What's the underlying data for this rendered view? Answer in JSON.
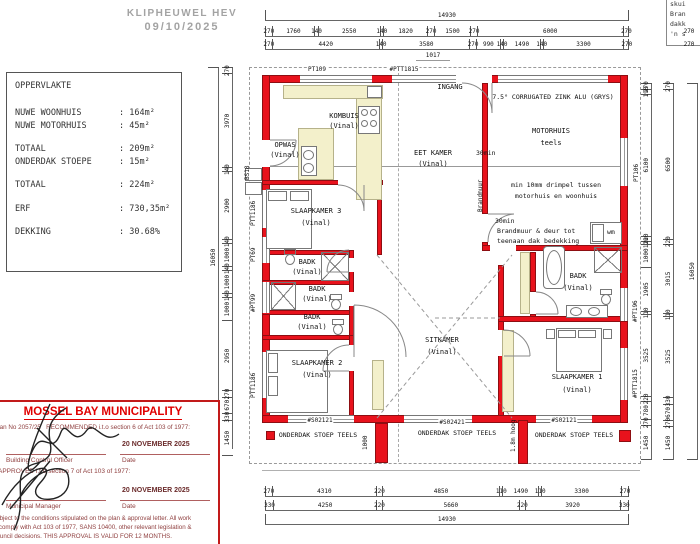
{
  "watermark": {
    "site": "KLIPHEUWEL HEV",
    "date": "09/10/2025"
  },
  "area_table": {
    "title": "OPPERVLAKTE",
    "rows": [
      {
        "label": "NUWE WOONHUIS",
        "value": ": 164m²"
      },
      {
        "label": "NUWE MOTORHUIS",
        "value": ":  45m²"
      },
      {
        "label": "TOTAAL",
        "value": ": 209m²"
      },
      {
        "label": "ONDERDAK STOEPE",
        "value": ": 15m²"
      },
      {
        "label": "TOTAAL",
        "value": ": 224m²"
      },
      {
        "label": "ERF",
        "value": ": 730,35m²"
      },
      {
        "label": "DEKKING",
        "value": ": 30.68%"
      }
    ]
  },
  "corner_note": {
    "lines": [
      "skui",
      "Bran",
      "dakk",
      "'n s"
    ]
  },
  "plan": {
    "rooms": {
      "kombuis": {
        "name": "KOMBUIS",
        "floor": "(Vinal)"
      },
      "opwas": {
        "name": "OPWAS",
        "floor": "(Vinal)"
      },
      "eetkamer": {
        "name": "EET KAMER",
        "floor": "(Vinal)"
      },
      "motorhuis": {
        "name": "MOTORHUIS",
        "floor": "teels"
      },
      "ingang": {
        "name": "INGANG"
      },
      "slaapkamer3": {
        "name": "SLAAPKAMER 3",
        "floor": "(Vinal)"
      },
      "badk_a": {
        "name": "BADK",
        "floor": "(Vinal)"
      },
      "badk_b": {
        "name": "BADK",
        "floor": "(Vinal)"
      },
      "badk_c": {
        "name": "BADK",
        "floor": "(Vinal)"
      },
      "badk_d": {
        "name": "BADK",
        "floor": "(Vinal)"
      },
      "slaapkamer2": {
        "name": "SLAAPKAMER 2",
        "floor": "(Vinal)"
      },
      "sitkamer": {
        "name": "SITKAMER",
        "floor": "(Vinal)"
      },
      "slaapkamer1": {
        "name": "SLAAPKAMER 1",
        "floor": "(Vinal)"
      }
    },
    "notes": {
      "roof": "7.5° CORRUGATED ZINK ALU (GRYS)",
      "fire30_top": "30min",
      "brandmuur": "Brandmuur",
      "threshold_1": "min 10mm drimpel tussen",
      "threshold_2": "motorhuis en woonhuis",
      "fire30_bottom": "30min",
      "firedoor_1": "Brandmuur & deur tot",
      "firedoor_2": "teenaan dak bedekking",
      "wm": "wm",
      "wall_height": "1.8m hoog",
      "stoep": "ONDERDAK STOEP TEELS"
    },
    "openings": {
      "pt109": "PT109",
      "ptt1815_top": "#PTT1815",
      "pt106": "PT106",
      "pt196": "#PT196",
      "ptt1815_right": "#PTT1815",
      "ptt1186_top": "PTT1186",
      "pt69": "PT69",
      "pt99": "#PT99",
      "ptt1186_bottom": "PTT1186",
      "bs18": "BS18",
      "s02121_left": "#S02121",
      "s02421": "#S02421",
      "s02121_right": "#S02121"
    }
  },
  "dims": {
    "top_total": [
      14930
    ],
    "top_row2": [
      270,
      1760,
      140,
      2550,
      140,
      1820,
      270,
      1500,
      270,
      6000,
      270
    ],
    "top_row3": [
      270,
      4420,
      140,
      3580,
      270,
      990,
      140,
      1490,
      140,
      3300,
      270
    ],
    "top_offset": "1017",
    "bottom_row1": [
      270,
      4310,
      220,
      4850,
      110,
      1490,
      110,
      3300,
      270
    ],
    "bottom_row2": [
      330,
      4250,
      220,
      5660,
      220,
      3920,
      330
    ],
    "bottom_total": [
      14930
    ],
    "left_col": [
      270,
      3970,
      140,
      2900,
      140,
      1000,
      140,
      1000,
      140,
      1000,
      2950,
      270,
      670,
      330,
      1450
    ],
    "left_total": [
      16050
    ],
    "right_inner": [
      270,
      190,
      6100,
      220,
      110,
      1000,
      1905,
      110,
      3525,
      220,
      780,
      270,
      1450
    ],
    "right_outer": [
      270,
      6500,
      220,
      3015,
      110,
      3525,
      330,
      670,
      270,
      1450
    ],
    "right_total": [
      16050
    ],
    "corner": [
      270,
      270
    ],
    "stoep_opening": "1000"
  },
  "stamp": {
    "title": "MOSSEL BAY MUNICIPALITY",
    "plan_no": "Plan No   2057/25",
    "recommended": "RECOMMENDED i.t.o section 6 of Act 103 of 1977:",
    "date1": "20 NOVEMBER 2025",
    "officer": "Building Control Officer",
    "date_label1": "Date",
    "approved": "APPROVED i.t.o section 7 of Act 103 of 1977:",
    "date2": "20 NOVEMBER 2025",
    "manager": "Municipal Manager",
    "date_label2": "Date",
    "footer1": "Subject to the conditions stipulated on the plan & approval letter. All work",
    "footer2": "to comply with Act 103 of 1977, SANS 10400, other relevant legislation &",
    "footer3": "Council decisions.     THIS APPROVAL IS VALID FOR 12 MONTHS."
  }
}
